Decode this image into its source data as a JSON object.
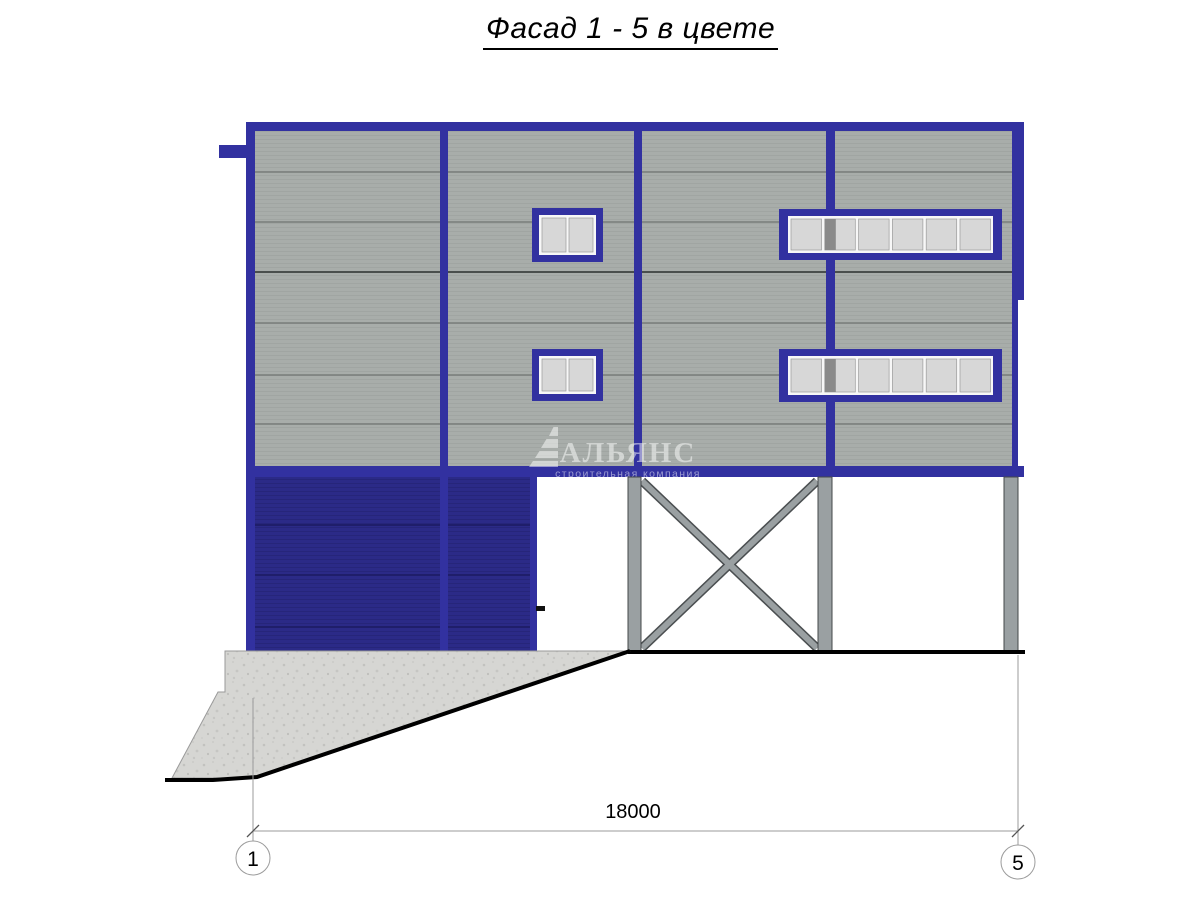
{
  "title": "Фасад 1 - 5 в цвете",
  "watermark": {
    "brand": "АЛЬЯНС",
    "tagline": "строительная компания"
  },
  "dimension": {
    "value": "18000"
  },
  "axes": {
    "left": {
      "label": "1"
    },
    "right": {
      "label": "5"
    }
  },
  "colors": {
    "frame_blue": "#3231a0",
    "door_navy": "#2b2a87",
    "panel_gray": "#a8adaa",
    "window_pane": "#d7d7d7",
    "steel_gray": "#9aa0a2",
    "concrete_gray": "#d6d6d3"
  }
}
